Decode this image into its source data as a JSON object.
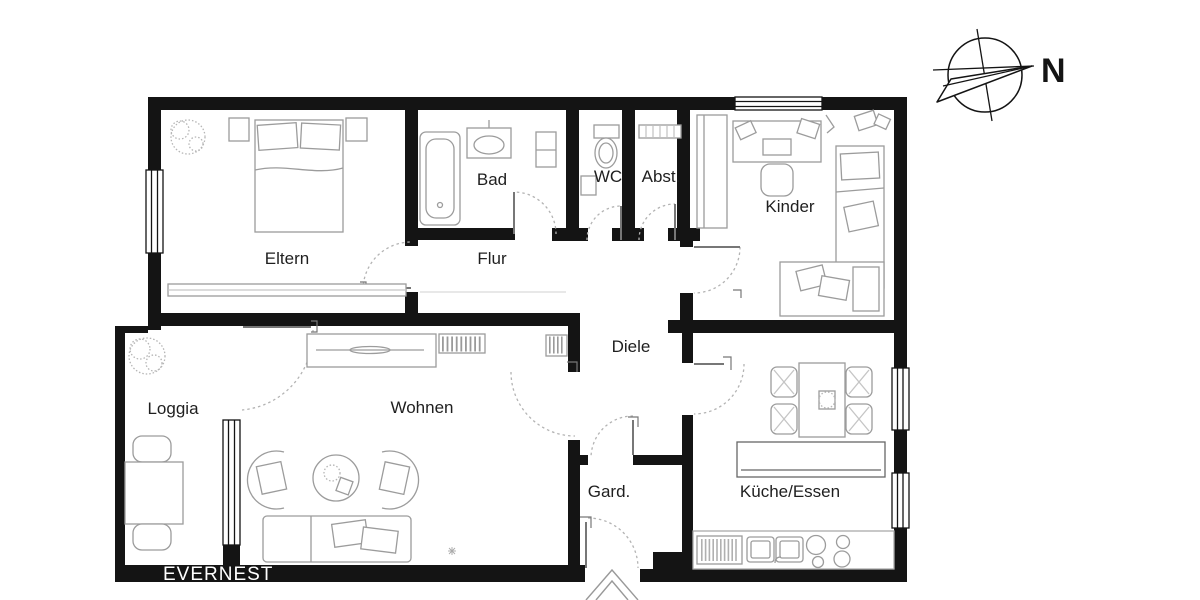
{
  "floorplan": {
    "rooms": {
      "eltern": {
        "label": "Eltern"
      },
      "bad": {
        "label": "Bad"
      },
      "wc": {
        "label": "WC"
      },
      "abstellraum": {
        "label": "Abst."
      },
      "kinder": {
        "label": "Kinder"
      },
      "flur": {
        "label": "Flur"
      },
      "diele": {
        "label": "Diele"
      },
      "loggia": {
        "label": "Loggia"
      },
      "wohnen": {
        "label": "Wohnen"
      },
      "garderobe": {
        "label": "Gard."
      },
      "kueche_essen": {
        "label": "Küche/Essen"
      }
    },
    "compass": {
      "north_label": "N"
    },
    "brand": {
      "logo_text": "EVERNEST"
    },
    "colors": {
      "background": "#ffffff",
      "wall": "#141414",
      "label_text": "#1f1f1f",
      "brand_text": "#ffffff",
      "furniture_line": "#9c9c9c",
      "door_arc": "#b3b3b3"
    }
  }
}
